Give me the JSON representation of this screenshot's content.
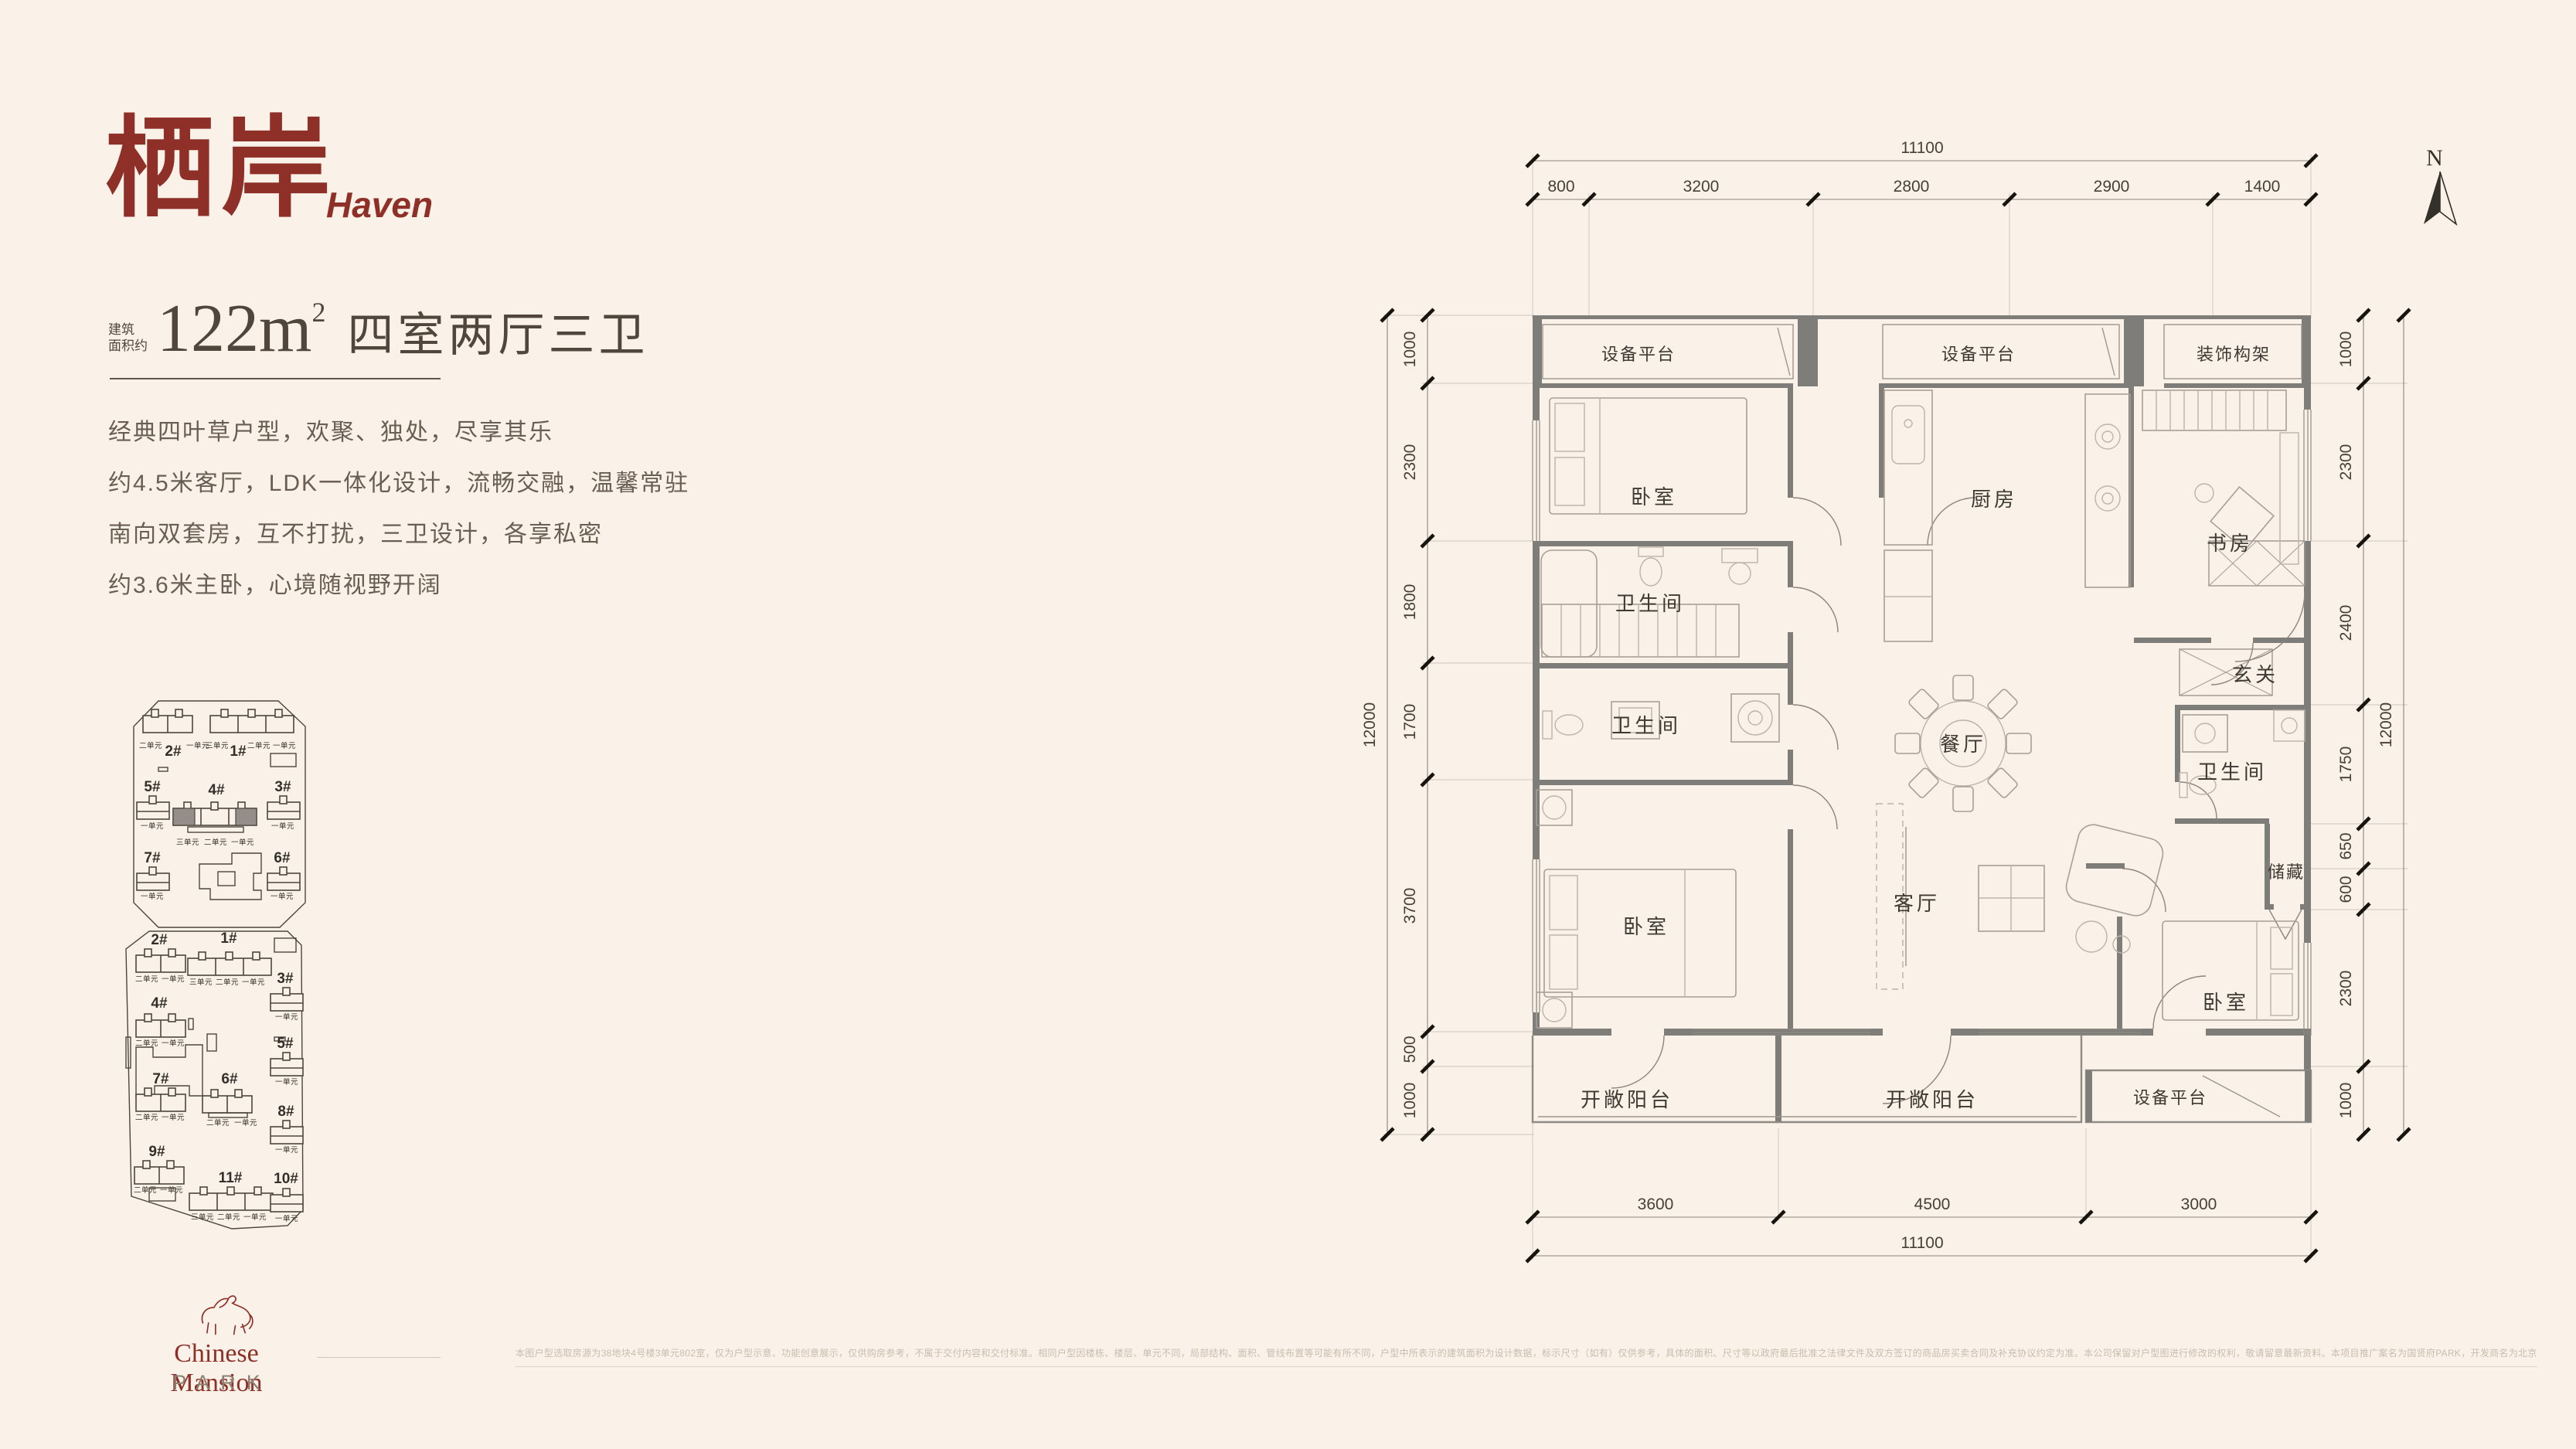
{
  "header": {
    "title_cn": "栖岸",
    "title_en": "Haven"
  },
  "spec": {
    "prefix_l1": "建筑",
    "prefix_l2": "面积约",
    "area": "122m",
    "area_sup": "2",
    "rooms": "四室两厅三卫"
  },
  "description": {
    "lines": [
      "经典四叶草户型，欢聚、独处，尽享其乐",
      "约4.5米客厅，LDK一体化设计，流畅交融，温馨常驻",
      "南向双套房，互不打扰，三卫设计，各享私密",
      "约3.6米主卧，心境随视野开阔"
    ]
  },
  "siteplan1": {
    "buildings": [
      {
        "id": "2#",
        "units": [
          "二单元",
          "一单元"
        ]
      },
      {
        "id": "1#",
        "units": [
          "三单元",
          "二单元",
          "一单元"
        ]
      },
      {
        "id": "5#",
        "units": [
          "一单元"
        ]
      },
      {
        "id": "4#",
        "units": [
          "三单元",
          "二单元",
          "一单元"
        ]
      },
      {
        "id": "3#",
        "units": [
          "一单元"
        ]
      },
      {
        "id": "7#",
        "units": [
          "一单元"
        ]
      },
      {
        "id": "6#",
        "units": [
          "一单元"
        ]
      }
    ]
  },
  "siteplan2": {
    "buildings": [
      {
        "id": "2#",
        "units": [
          "二单元",
          "一单元"
        ]
      },
      {
        "id": "1#",
        "units": [
          "三单元",
          "二单元",
          "一单元"
        ]
      },
      {
        "id": "3#",
        "units": [
          "一单元"
        ]
      },
      {
        "id": "4#",
        "units": [
          "二单元",
          "一单元"
        ]
      },
      {
        "id": "5#",
        "units": [
          "一单元"
        ]
      },
      {
        "id": "7#",
        "units": [
          "二单元",
          "一单元"
        ]
      },
      {
        "id": "6#",
        "units": [
          "二单元",
          "一单元"
        ]
      },
      {
        "id": "8#",
        "units": [
          "一单元"
        ]
      },
      {
        "id": "9#",
        "units": [
          "二单元",
          "一单元"
        ]
      },
      {
        "id": "11#",
        "units": [
          "三单元",
          "二单元",
          "一单元"
        ]
      },
      {
        "id": "10#",
        "units": [
          "一单元"
        ]
      }
    ]
  },
  "floorplan": {
    "north": "N",
    "rooms": {
      "equip_top_left": "设备平台",
      "equip_top_mid": "设备平台",
      "deco_frame": "装饰构架",
      "bedroom_tl": "卧室",
      "kitchen": "厨房",
      "study": "书房",
      "bath1": "卫生间",
      "foyer": "玄关",
      "bath2": "卫生间",
      "dining": "餐厅",
      "bath3": "卫生间",
      "storage": "储藏",
      "bedroom_bl": "卧室",
      "living": "客厅",
      "bedroom_br": "卧室",
      "balcony_left": "开敞阳台",
      "balcony_mid": "开敞阳台",
      "equip_bottom": "设备平台"
    },
    "dims": {
      "top_total": "11100",
      "top_segs": [
        "800",
        "3200",
        "2800",
        "2900",
        "1400"
      ],
      "bottom_segs": [
        "3600",
        "4500",
        "3000"
      ],
      "bottom_total": "11100",
      "left_total": "12000",
      "left_segs": [
        "1000",
        "2300",
        "1800",
        "1700",
        "3700",
        "500",
        "1000"
      ],
      "right_segs": [
        "1000",
        "2300",
        "2400",
        "1750",
        "650",
        "600",
        "2300",
        "1000"
      ],
      "right_total": "12000"
    }
  },
  "logo": {
    "name": "Chinese Mansion",
    "sub": "PARK"
  },
  "footer": {
    "disclaimer": "本图户型选取房源为38地块4号楼3单元802室，仅为户型示意、功能创意展示，仅供购房参考，不属于交付内容和交付标准。相同户型因楼栋、楼层、单元不同，局部结构、面积、管线布置等可能有所不同，户型中所表示的建筑面积为设计数据，标示尺寸（如有）仅供参考，具体的面积、尺寸等以政府最后批准之法律文件及双方签订的商品房买卖合同及补充协议约定为准。本公司保留对户型图进行修改的权利，敬请留意最新资料。本项目推广案名为国贤府PARK，开发商名为北京合诚未来房地产开发有限公司，本资料制作时间为2026年2月。"
  }
}
